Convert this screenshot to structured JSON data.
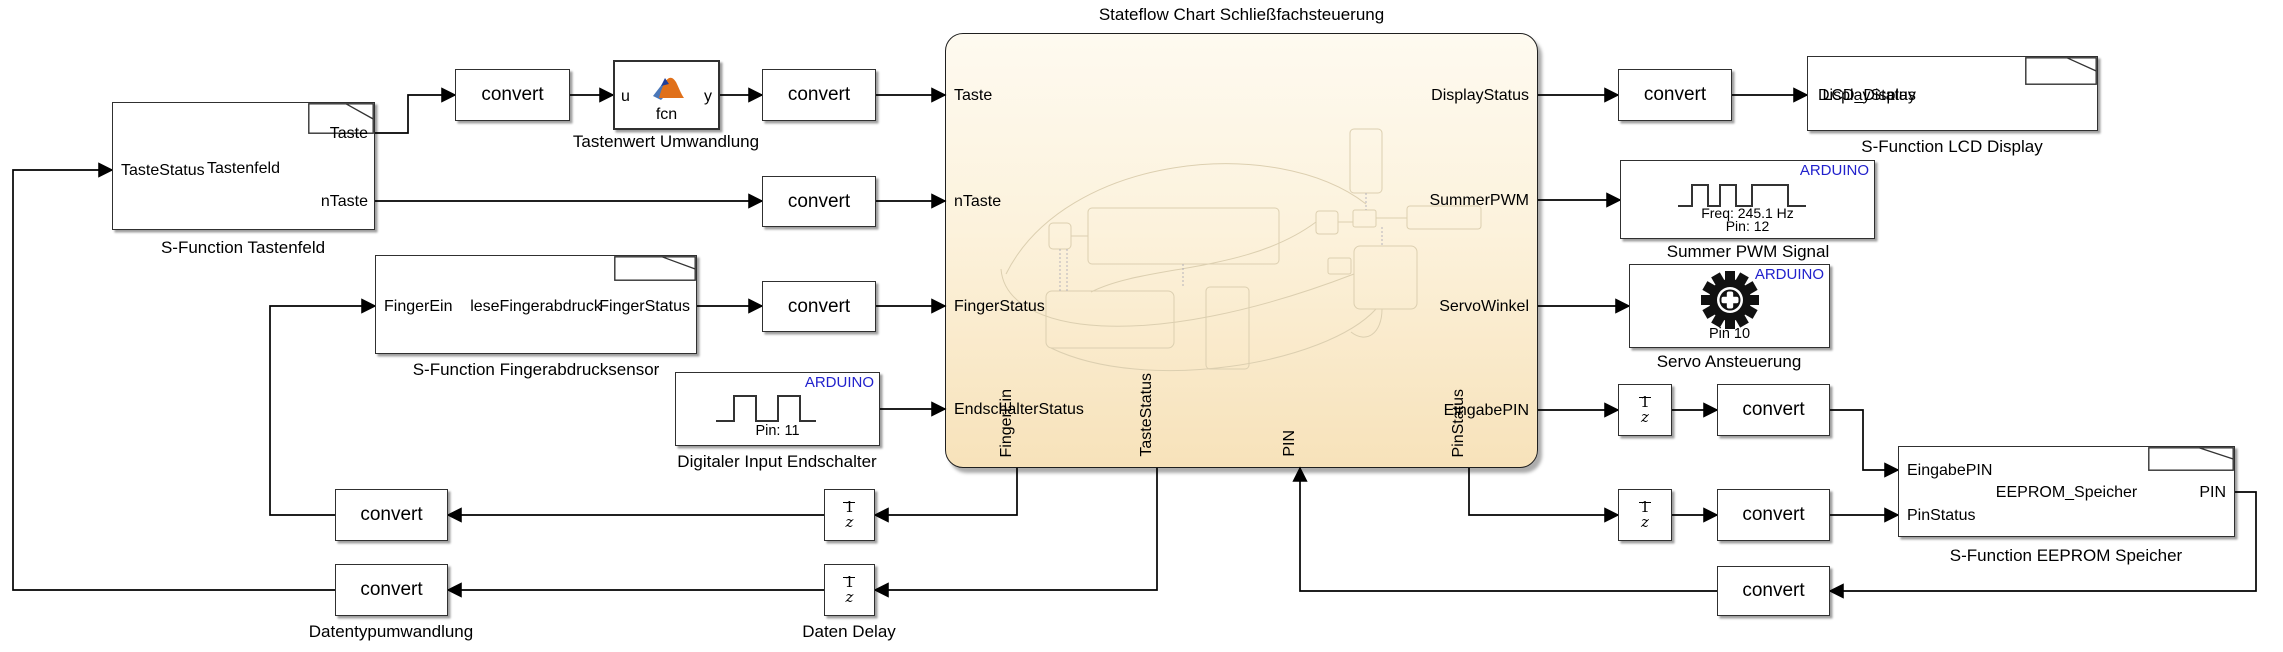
{
  "colors": {
    "arduino_blue": "#2121cc",
    "wire": "#000000",
    "chart_fill_top": "#fefaf0",
    "chart_fill_bottom": "#f7e2ba",
    "block_border": "#303030",
    "matlab_orange": "#e0701a",
    "matlab_blue": "#4a77b8"
  },
  "labels": {
    "convert": "convert",
    "arduino": "ARDUINO",
    "delay_num": "1",
    "delay_den": "z"
  },
  "title": "Stateflow Chart Schließfachsteuerung",
  "chart": {
    "inputs_left": [
      "Taste",
      "nTaste",
      "FingerStatus",
      "EndschalterStatus"
    ],
    "outputs_right": [
      "DisplayStatus",
      "SummerPWM",
      "ServoWinkel",
      "EingabePIN"
    ],
    "bottom_ports": [
      "FingerEin",
      "TasteStatus",
      "PIN",
      "PinStatus"
    ]
  },
  "tastenfeld": {
    "input": "TasteStatus",
    "name": "Tastenfeld",
    "output_top": "Taste",
    "output_bottom": "nTaste",
    "caption": "S-Function Tastenfeld"
  },
  "tastenwert": {
    "input": "u",
    "output": "y",
    "fcn": "fcn",
    "caption": "Tastenwert Umwandlung"
  },
  "fingerabdruck": {
    "input": "FingerEin",
    "name": "leseFingerabdruck",
    "output": "FingerStatus",
    "caption": "S-Function Fingerabdrucksensor"
  },
  "endschalter": {
    "pin": "Pin: 11",
    "caption": "Digitaler Input Endschalter"
  },
  "lcd": {
    "input": "DisplayStatus",
    "name": "LCD_Display",
    "caption": "S-Function LCD Display"
  },
  "summer": {
    "freq": "Freq: 245.1 Hz",
    "pin": "Pin: 12",
    "caption": "Summer PWM Signal"
  },
  "servo": {
    "pin": "Pin 10",
    "caption": "Servo Ansteuerung"
  },
  "eeprom": {
    "input1": "EingabePIN",
    "input2": "PinStatus",
    "name": "EEPROM_Speicher",
    "output": "PIN",
    "caption": "S-Function EEPROM Speicher"
  },
  "datentyp": {
    "caption": "Datentypumwandlung"
  },
  "daten_delay": {
    "caption": "Daten Delay"
  }
}
